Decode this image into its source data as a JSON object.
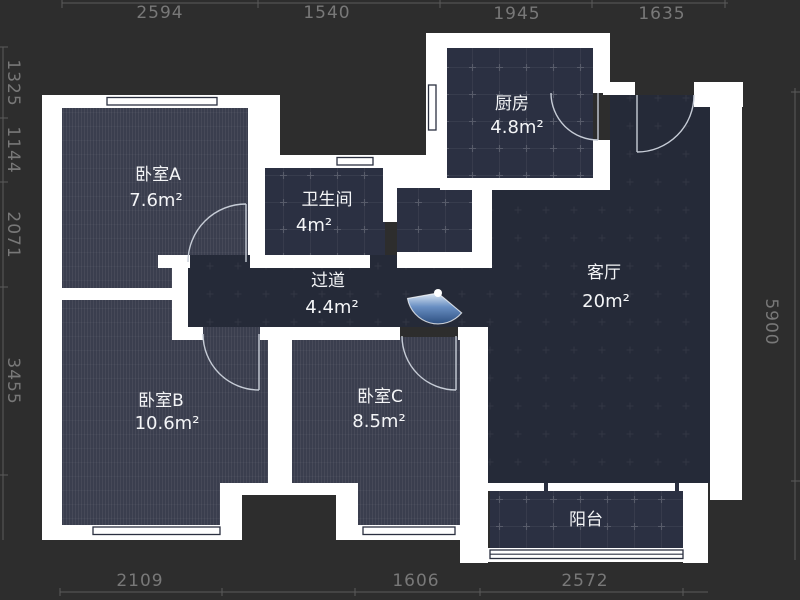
{
  "title": "apartment-floor-plan",
  "colors": {
    "background": "#2d2d2d",
    "wall": "#ffffff",
    "bedroom_fill": "#3a3e4e",
    "tile_fill": "#2b3042",
    "living_fill": "#252a38",
    "ruler_text": "#787878",
    "ruler_line": "#5a5a5a",
    "label_text": "#f4f5f7",
    "window_line": "#2b3040",
    "door_arc": "#c6ccd6",
    "entry_marker_blue": "#688ec2"
  },
  "rulers": {
    "top": [
      "2594",
      "1540",
      "1945",
      "1635"
    ],
    "left": [
      "1325",
      "1144",
      "2071",
      "3455"
    ],
    "right": [
      "5900"
    ],
    "bottom": [
      "2109",
      "1606",
      "2572"
    ]
  },
  "rooms": {
    "bedroomA": {
      "name": "卧室A",
      "area": "7.6m²"
    },
    "bathroom": {
      "name": "卫生间",
      "area": "4m²"
    },
    "kitchen": {
      "name": "厨房",
      "area": "4.8m²"
    },
    "hallway": {
      "name": "过道",
      "area": "4.4m²"
    },
    "living": {
      "name": "客厅",
      "area": "20m²"
    },
    "bedroomB": {
      "name": "卧室B",
      "area": "10.6m²"
    },
    "bedroomC": {
      "name": "卧室C",
      "area": "8.5m²"
    },
    "balcony": {
      "name": "阳台"
    }
  },
  "icons": {
    "entry_door_marker": "entry-door-fan"
  }
}
